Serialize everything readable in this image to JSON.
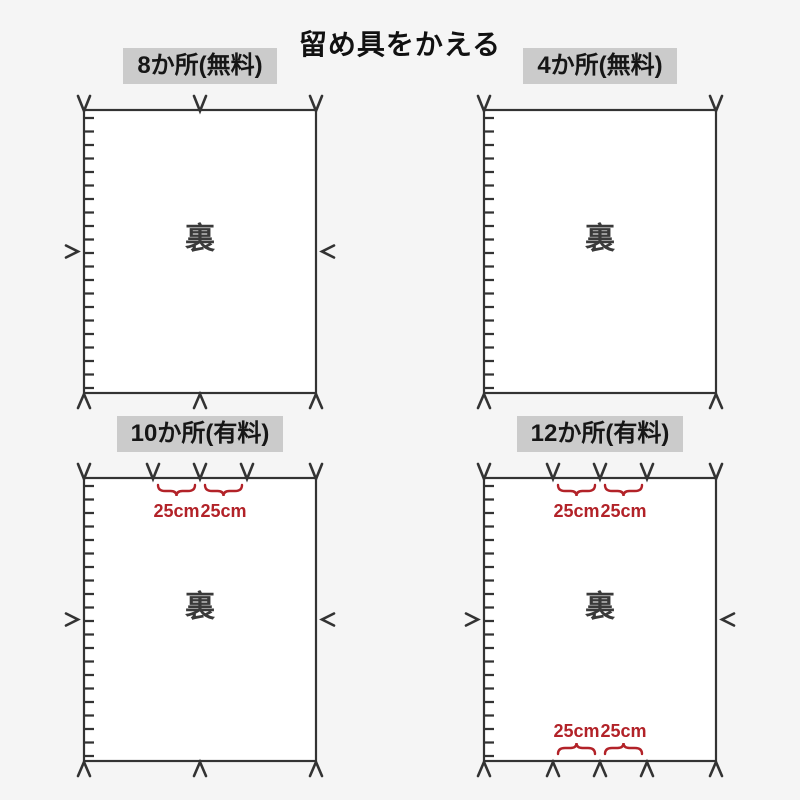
{
  "title": "留め具をかえる",
  "back_label": "裏",
  "measure_label": "25cm",
  "colors": {
    "page_bg": "#f5f5f5",
    "label_bg": "#cbcbcb",
    "line": "#333333",
    "text": "#161616",
    "back_text": "#3a3a3a",
    "accent_red": "#b22228",
    "rect_fill": "#ffffff"
  },
  "panels": [
    {
      "label": "8か所(無料)",
      "fastener_count": 8,
      "top_mark_positions": [
        84,
        200,
        316
      ],
      "bottom_mark_positions": [
        84,
        200,
        316
      ],
      "side_marks": true,
      "top_measures": false,
      "bottom_measures": false
    },
    {
      "label": "4か所(無料)",
      "fastener_count": 4,
      "top_mark_positions": [
        84,
        316
      ],
      "bottom_mark_positions": [
        84,
        316
      ],
      "side_marks": false,
      "top_measures": false,
      "bottom_measures": false
    },
    {
      "label": "10か所(有料)",
      "fastener_count": 10,
      "top_mark_positions": [
        84,
        153,
        200,
        247,
        316
      ],
      "bottom_mark_positions": [
        84,
        200,
        316
      ],
      "side_marks": true,
      "top_measures": true,
      "bottom_measures": false
    },
    {
      "label": "12か所(有料)",
      "fastener_count": 12,
      "top_mark_positions": [
        84,
        153,
        200,
        247,
        316
      ],
      "bottom_mark_positions": [
        84,
        153,
        200,
        247,
        316
      ],
      "side_marks": true,
      "top_measures": true,
      "bottom_measures": true
    }
  ]
}
